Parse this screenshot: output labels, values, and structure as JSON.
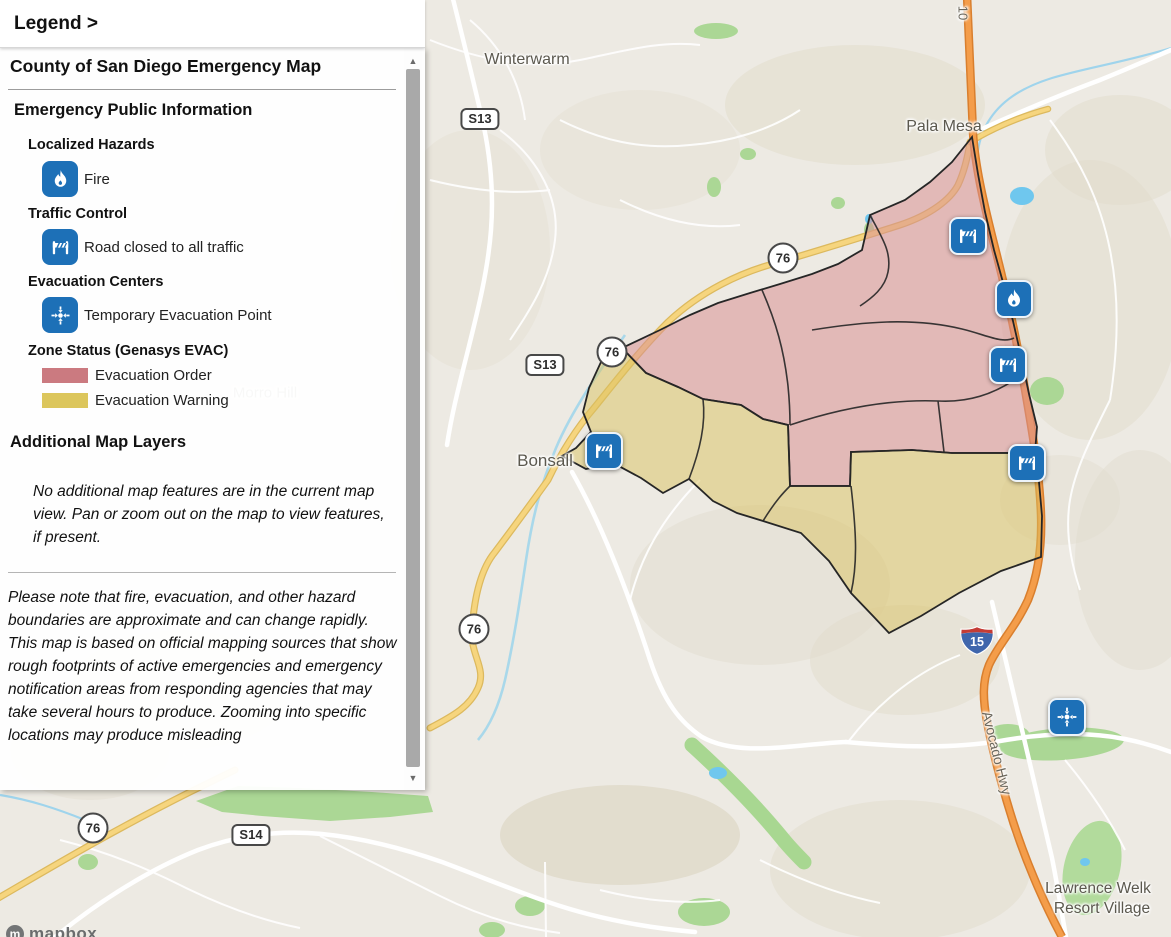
{
  "legend": {
    "title": "Legend >",
    "map_title": "County of San Diego Emergency Map",
    "section_public_info": "Emergency Public Information",
    "group_localized_hazards": "Localized Hazards",
    "item_fire": "Fire",
    "group_traffic_control": "Traffic Control",
    "item_road_closed": "Road closed to all traffic",
    "group_evacuation_centers": "Evacuation Centers",
    "item_temp_evac_point": "Temporary Evacuation Point",
    "group_zone_status": "Zone Status (Genasys EVAC)",
    "item_evac_order": "Evacuation Order",
    "item_evac_warning": "Evacuation Warning",
    "section_additional_layers": "Additional Map Layers",
    "note_no_features": "No additional map features are in the current map view. Pan or zoom out on the map to view features, if present.",
    "disclaimer": "Please note that fire, evacuation, and other hazard boundaries are approximate and can change rapidly. This map is based on official mapping sources that show rough footprints of active emergencies and emergency notification areas from responding agencies that may take several hours to produce. Zooming into specific locations may produce misleading",
    "colors": {
      "evacuation_order": "#cb7a80",
      "evacuation_warning": "#dcc65c",
      "icon_blue": "#1d70b7"
    }
  },
  "map": {
    "labels": {
      "winterwarm": "Winterwarm",
      "pala_mesa": "Pala Mesa",
      "bonsall": "Bonsall",
      "morro_hill": "Morro Hill",
      "lawrence_welk_line1": "Lawrence Welk",
      "lawrence_welk_line2": "Resort Village",
      "avocado_hwy": "Avocado Hwy",
      "road_fragment": "10"
    },
    "shields": {
      "s13": "S13",
      "s14": "S14",
      "sr76": "76",
      "i15": "15"
    },
    "zone_colors": {
      "evacuation_order_fill": "#d98f94",
      "evacuation_warning_fill": "#d9c260",
      "zone_border": "#262626"
    },
    "attribution": "mapbox"
  }
}
